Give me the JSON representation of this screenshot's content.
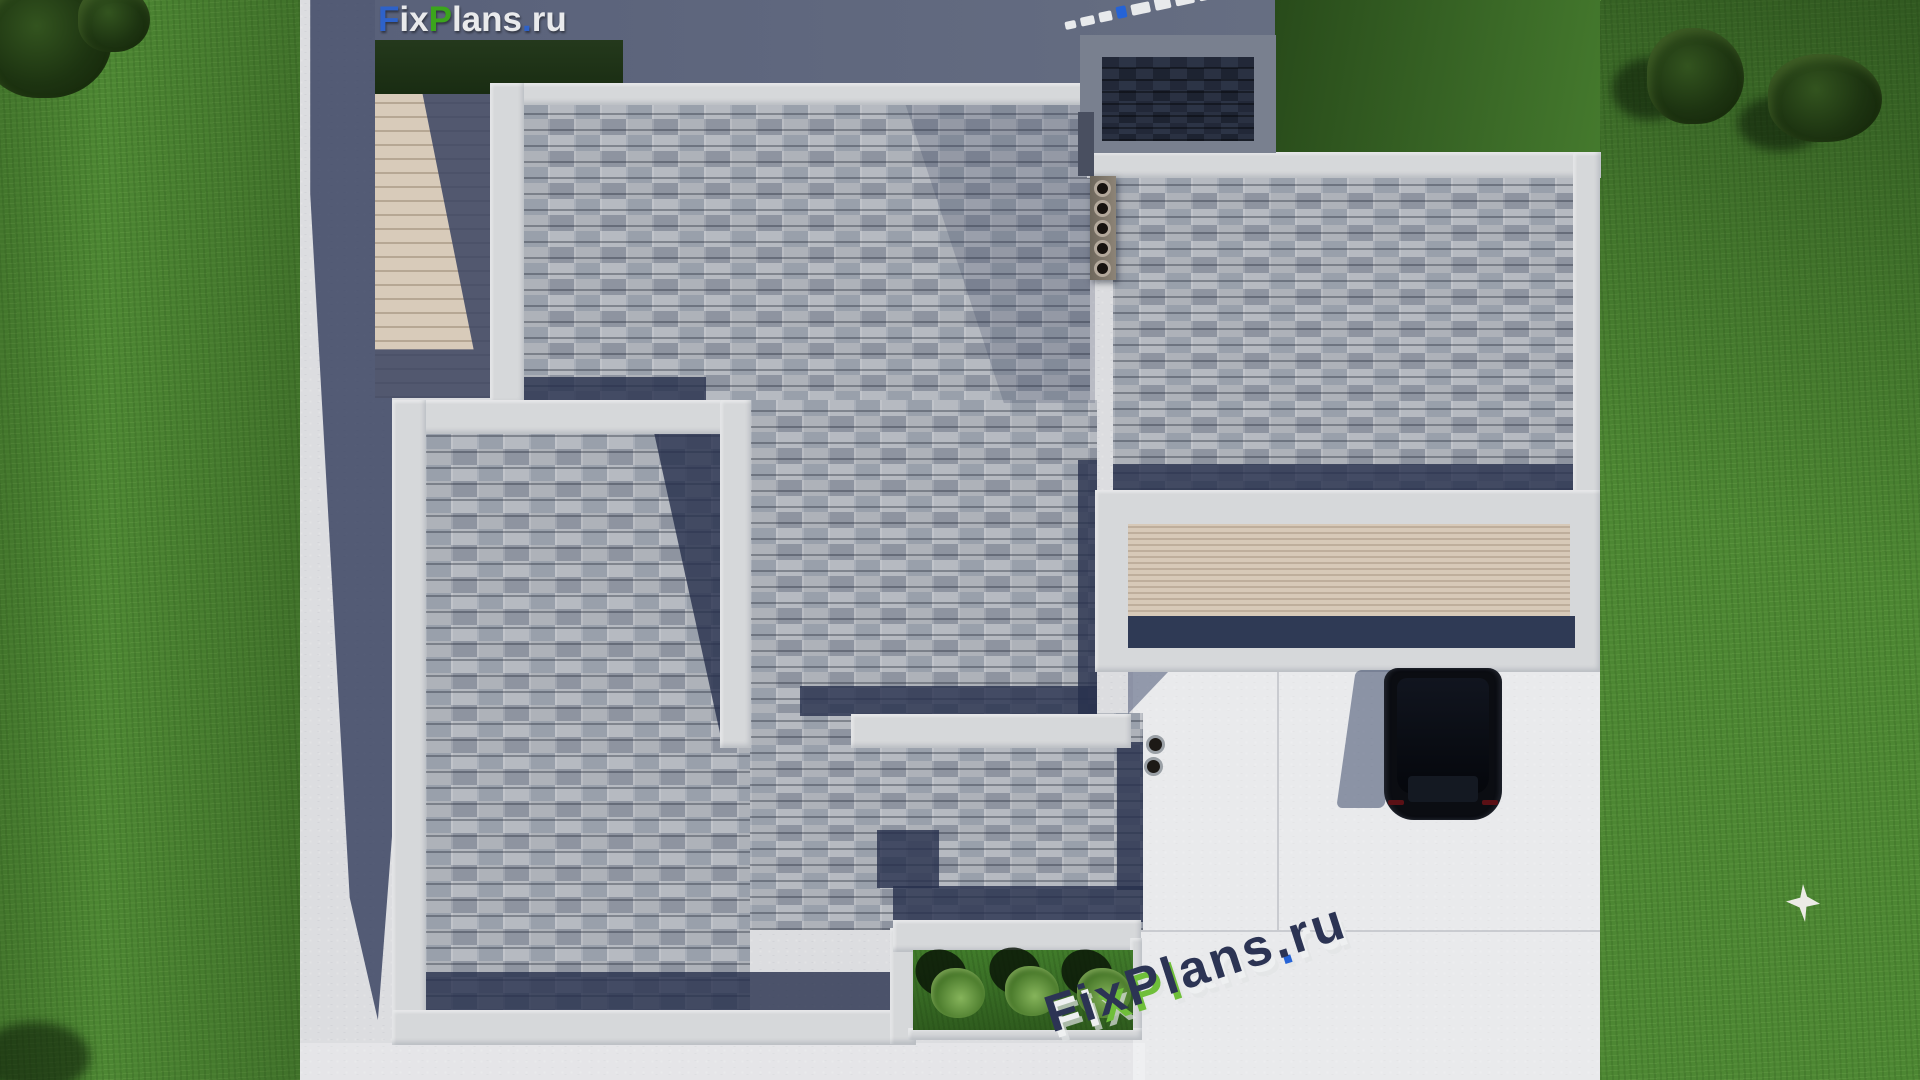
{
  "brand": {
    "logo_segments": [
      {
        "text": "F",
        "color": "#2e62c9"
      },
      {
        "text": "ix",
        "color": "#e9eaec"
      },
      {
        "text": "P",
        "color": "#3ba51c"
      },
      {
        "text": "lans",
        "color": "#e9eaec"
      },
      {
        "text": ".",
        "color": "#2e62c9"
      },
      {
        "text": "ru",
        "color": "#e9eaec"
      }
    ],
    "watermark_text": "FixPlans.ru",
    "watermark_bottom_letters": [
      {
        "ch": "F",
        "extrude": "#eef0f1"
      },
      {
        "ch": "i",
        "extrude": "#eef0f1"
      },
      {
        "ch": "x",
        "extrude": "#6fbf3a"
      },
      {
        "ch": "P",
        "extrude": "#6fbf3a"
      },
      {
        "ch": "l",
        "extrude": "#6fbf3a"
      },
      {
        "ch": "a",
        "extrude": "#eef0f1"
      },
      {
        "ch": "n",
        "extrude": "#eef0f1"
      },
      {
        "ch": "s",
        "extrude": "#eef0f1"
      },
      {
        "ch": ".",
        "extrude": "#2563d6"
      },
      {
        "ch": "r",
        "extrude": "#eef0f1"
      },
      {
        "ch": "u",
        "extrude": "#eef0f1"
      }
    ],
    "watermark_top_blocks": [
      {
        "w": 13,
        "h": 8,
        "color": "#e8eaec"
      },
      {
        "w": 15,
        "h": 9,
        "color": "#e8eaec"
      },
      {
        "w": 15,
        "h": 10,
        "color": "#e8eaec"
      },
      {
        "w": 12,
        "h": 12,
        "color": "#2563d6"
      },
      {
        "w": 21,
        "h": 11,
        "color": "#e8eaec"
      },
      {
        "w": 19,
        "h": 12,
        "color": "#e8eaec"
      },
      {
        "w": 21,
        "h": 13,
        "color": "#e8eaec"
      },
      {
        "w": 15,
        "h": 17,
        "color": "#e8eaec"
      },
      {
        "w": 17,
        "h": 11,
        "color": "#3ba51c"
      }
    ]
  },
  "scene": {
    "description": "top-down 3d render of flat-roof house",
    "house": {
      "roof_material": "gray shingles",
      "parapet_color": "#d6d8da",
      "chimney_flue_count": 5,
      "roof_vent_count": 2,
      "flue_offsets_y": [
        10,
        30,
        50,
        70,
        90
      ]
    },
    "landscape": {
      "planter_bush_count": 3,
      "bushes": [
        {
          "x": 18,
          "y": 18
        },
        {
          "x": 92,
          "y": 16
        },
        {
          "x": 164,
          "y": 18
        }
      ],
      "trees_top_right": 2,
      "trees_top_left": 2,
      "bird_on_lawn": true
    },
    "vehicle": {
      "type": "car",
      "body_color": "#0b0d12"
    }
  },
  "palette": {
    "grass_lit": "#4d8733",
    "grass_shadow": "#22401b",
    "concrete": "#dcdde0",
    "parapet": "#d6d8da",
    "shingle": "#a6abb3",
    "shadow_navy": "#27304c",
    "terrace": "#636b80",
    "deck_wood": "#d8cbba"
  }
}
